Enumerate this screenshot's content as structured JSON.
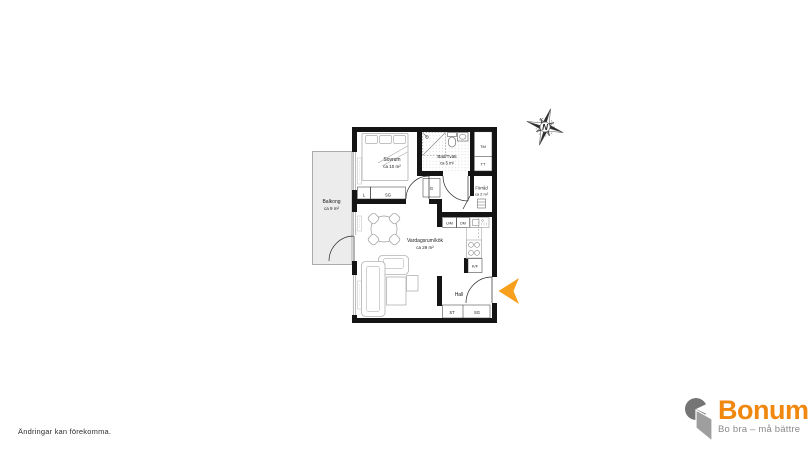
{
  "disclaimer": "Ändringar kan förekomma.",
  "floorplan": {
    "rooms": [
      {
        "name": "Sovrum",
        "area": "ca 10 m²"
      },
      {
        "name": "Bad/Tvätt",
        "area": "ca 5 m²"
      },
      {
        "name": "Förråd",
        "area": "ca 2 m²"
      },
      {
        "name": "Vardagsrum/kök",
        "area": "ca 29 m²"
      },
      {
        "name": "Hall",
        "area": ""
      },
      {
        "name": "Balkong",
        "area": "ca 9 m²"
      }
    ],
    "fixtures": {
      "linen_closet": "L",
      "wardrobe_bedroom": "SG",
      "wardrobe_small": "G",
      "washing_machine": "TM",
      "tumble_dryer": "TT",
      "micro_oven": "U/M",
      "dishwasher": "DM",
      "fridge_freezer": "K/F",
      "cleaning_closet": "ST",
      "wardrobe_hall": "SG"
    },
    "compass_label": "N"
  },
  "colors": {
    "entrance_arrow": "#F6A01E",
    "brand_orange": "#F0870F",
    "logo_gray_dark": "#757575",
    "logo_gray_light": "#9E9E9E",
    "wall_black": "#141414",
    "balcony_fill": "#ECECEC"
  },
  "logo": {
    "name": "Bonum",
    "tagline": "Bo bra – må bättre"
  }
}
